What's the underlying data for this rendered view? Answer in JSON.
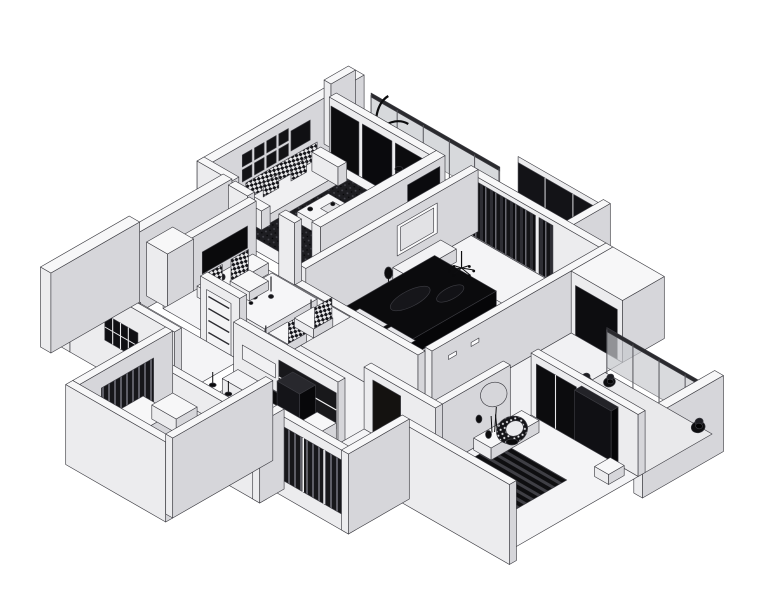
{
  "image": {
    "description": "Monochrome 3D isometric cutaway floor plan rendering of an apartment",
    "background": "#ffffff"
  },
  "colors": {
    "background": "#ffffff",
    "outline": "#3c3c42",
    "wall_top": "#f7f7f8",
    "wall_sw": "#ececee",
    "wall_se": "#d6d6da",
    "floor": "#f4f4f6",
    "floor_hall": "#f1f1f3",
    "floor_balcony": "#e9e9eb",
    "glass": "#c9cbcf",
    "glass_dark": "#131317",
    "rail_dark": "#2a2a2e",
    "dark": "#0c0c0e",
    "dark_soft": "#1b1b1f",
    "white": "#fbfbfc",
    "rug_base": "#1d1d21",
    "rug_dot": "#4a4a52",
    "checker_light": "#e8e8ea",
    "checker_dark": "#15151a",
    "stripe_a": "#0e0e10",
    "stripe_b": "#3f3f45",
    "slat_bg": "#17171a",
    "slat_bar": "#5e5e66",
    "curtain_a": "#2e2e34",
    "curtain_b": "#0d0d10",
    "curtain_c": "#6a6a72",
    "dot_bg": "#141418"
  },
  "scene": {
    "type": "isometric-floorplan",
    "rooms": [
      {
        "name": "living-room",
        "furniture": [
          "dark-textured-rug",
          "white-coffee-table",
          "tufted-sofa",
          "wall-picture-frames",
          "floor-lamp",
          "corner-plant",
          "glass-balcony-doors"
        ]
      },
      {
        "name": "dining-area",
        "furniture": [
          "dining-table",
          "four-checkered-chairs",
          "wall-tv",
          "console",
          "tall-wardrobe",
          "paneled-door"
        ]
      },
      {
        "name": "entrance-hall",
        "furniture": [
          "picture-frame-row",
          "console-with-vase",
          "grille-window"
        ]
      },
      {
        "name": "kitchen",
        "furniture": [
          "island-counter",
          "dark-tall-cabinet",
          "cooktop",
          "washing-machine",
          "pendant-lights",
          "backsplash-cabinets"
        ]
      },
      {
        "name": "master-bedroom",
        "furniture": [
          "black-duvet-bed",
          "pillows",
          "nightstands",
          "dresser-with-mirror",
          "dark-curtains",
          "chandelier",
          "desk"
        ]
      },
      {
        "name": "second-bedroom",
        "furniture": [
          "ring-mirror",
          "desk-console",
          "polka-dot-round-chair",
          "striped-dark-rug",
          "dark-wardrobe",
          "bench"
        ]
      },
      {
        "name": "bathroom",
        "furniture": [
          "dark-door",
          "slatted-shutter-panels"
        ]
      }
    ],
    "balconies": [
      "top-balcony-with-palm-and-glass-railing",
      "middle-balcony-dark-glazing",
      "right-balcony-with-plants",
      "bottom-left-balcony-with-slat-screen"
    ]
  }
}
